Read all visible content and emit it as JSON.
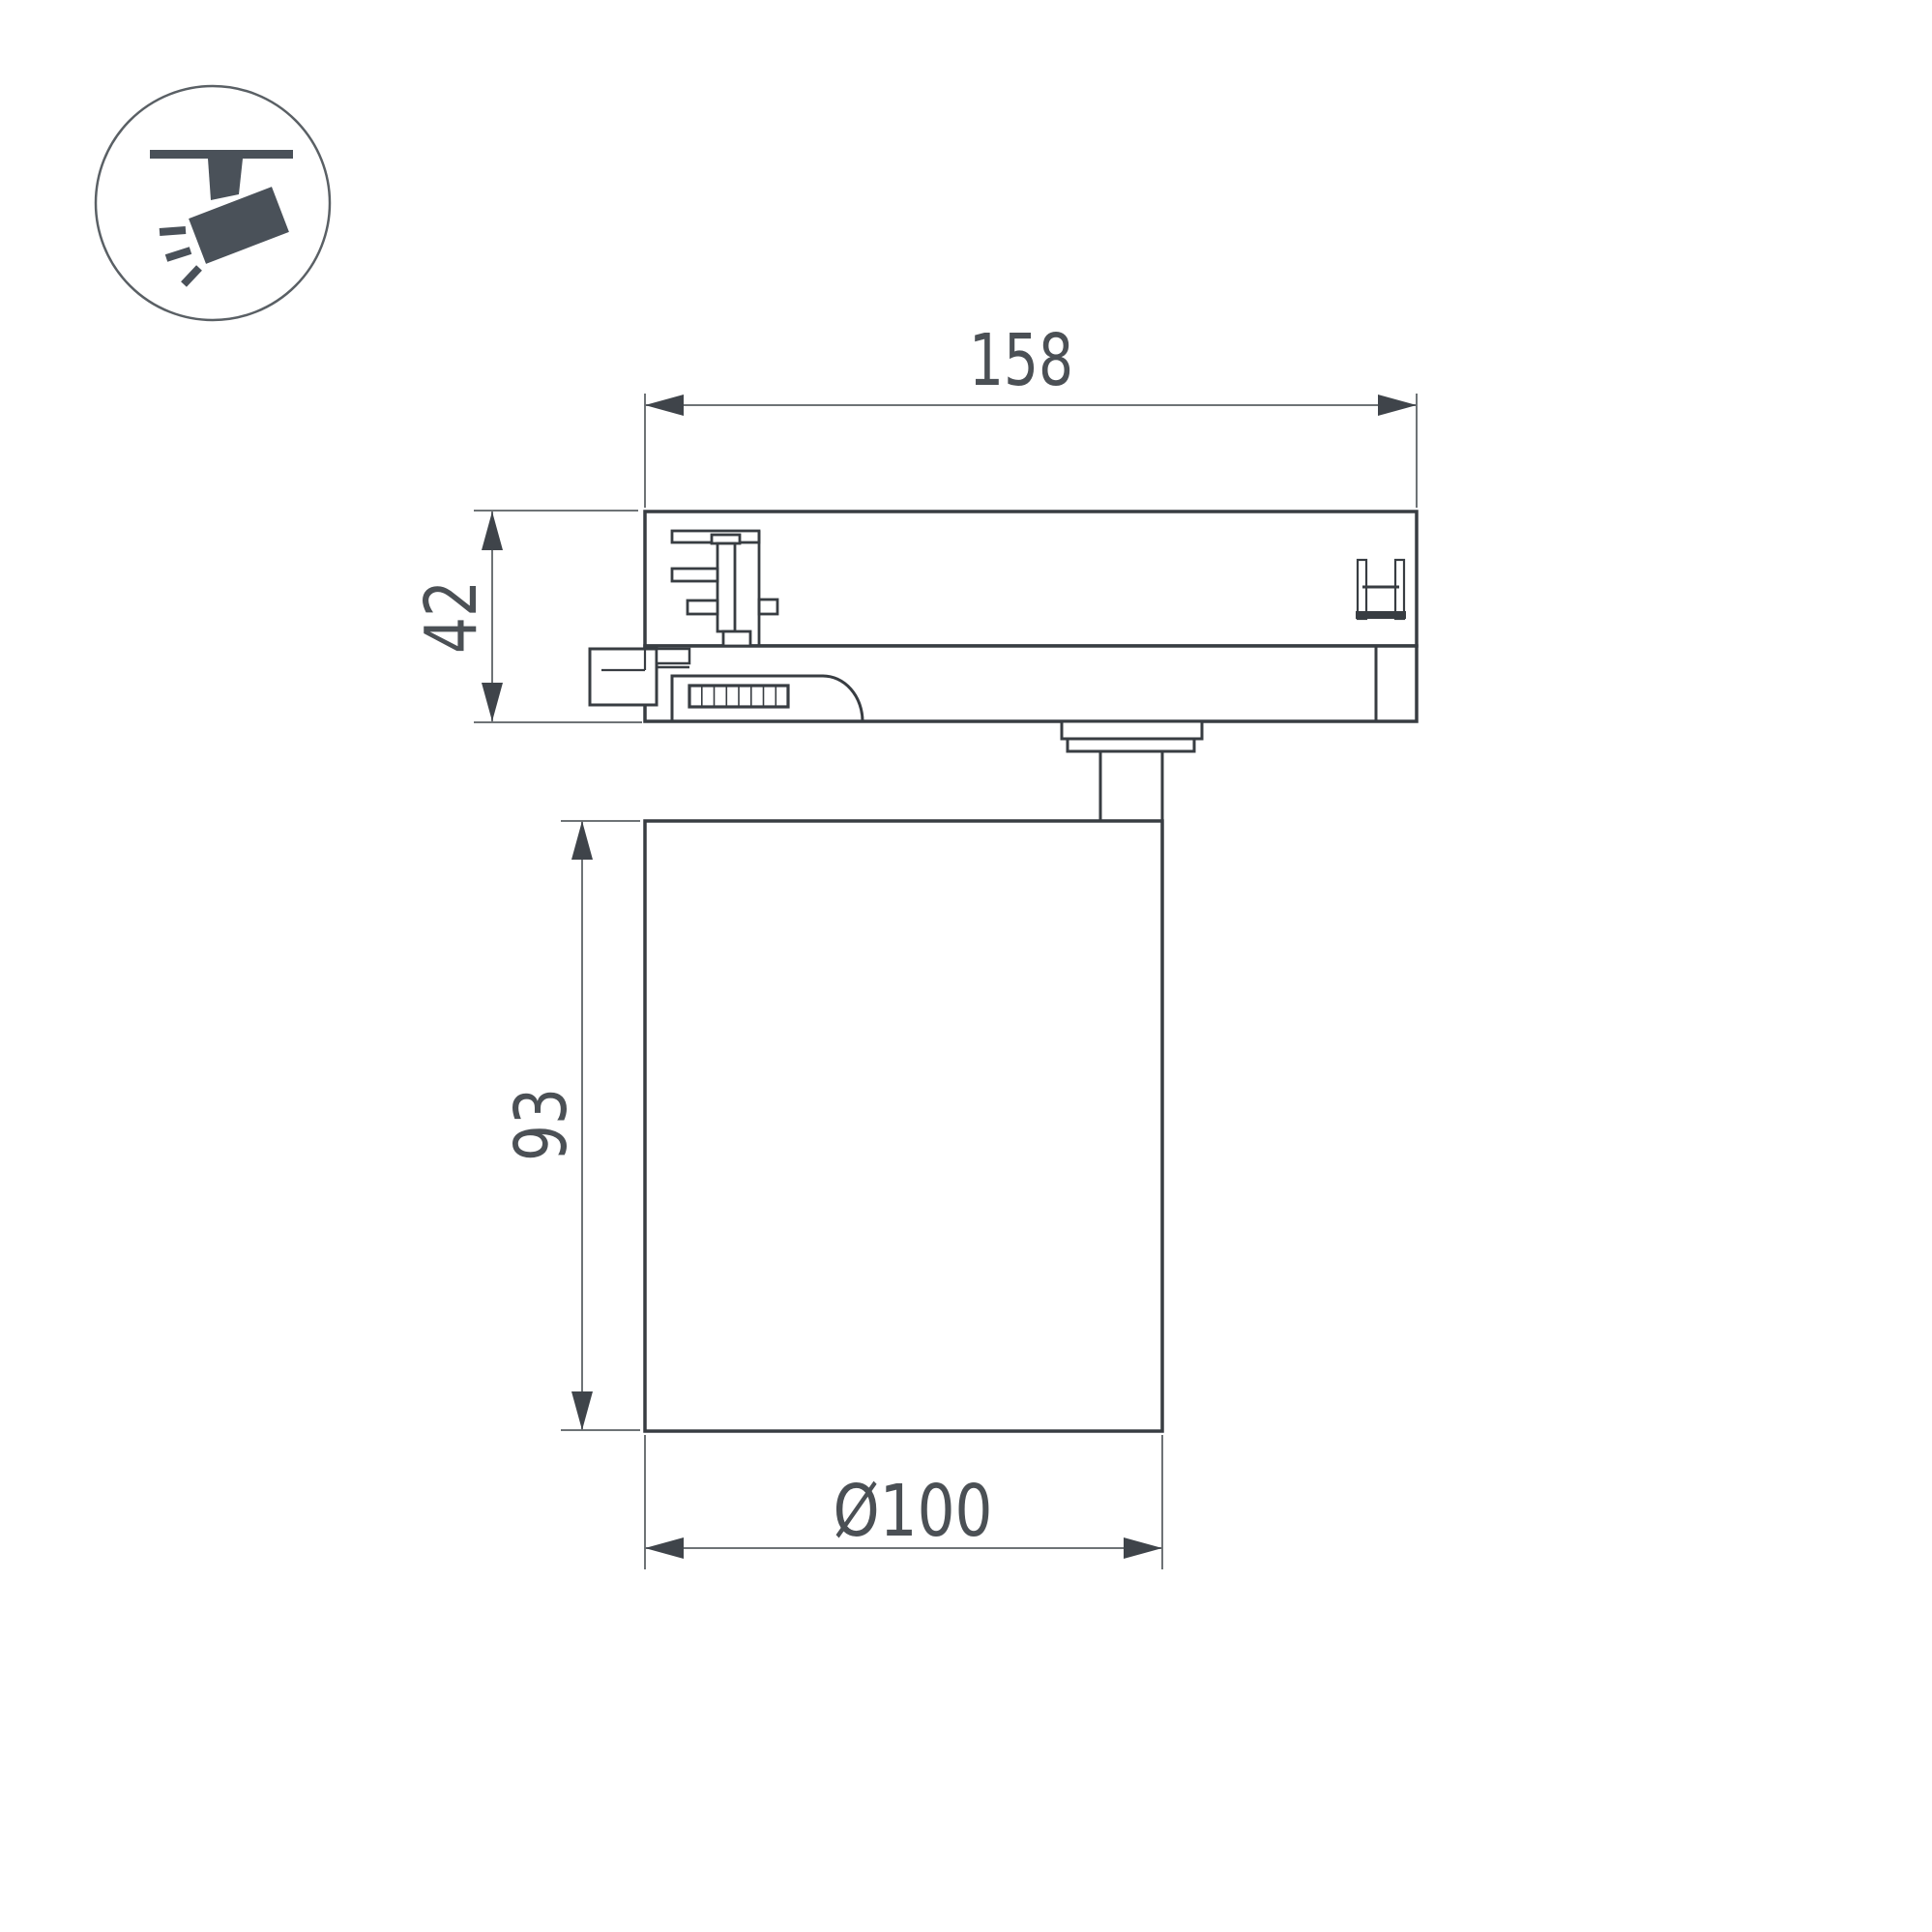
{
  "drawing": {
    "title": "track-mounted spotlight technical drawing",
    "dimensions": {
      "track_adapter_width": "158",
      "track_adapter_height": "42",
      "body_height": "93",
      "body_diameter": "Ø100"
    },
    "colors": {
      "outline": "#383d42",
      "dimension_lines": "#6e7376",
      "dimension_text": "#4b5055",
      "icon": "#4a5159",
      "background": "#ffffff"
    }
  },
  "legend": {
    "icon": "track-spotlight-icon"
  }
}
